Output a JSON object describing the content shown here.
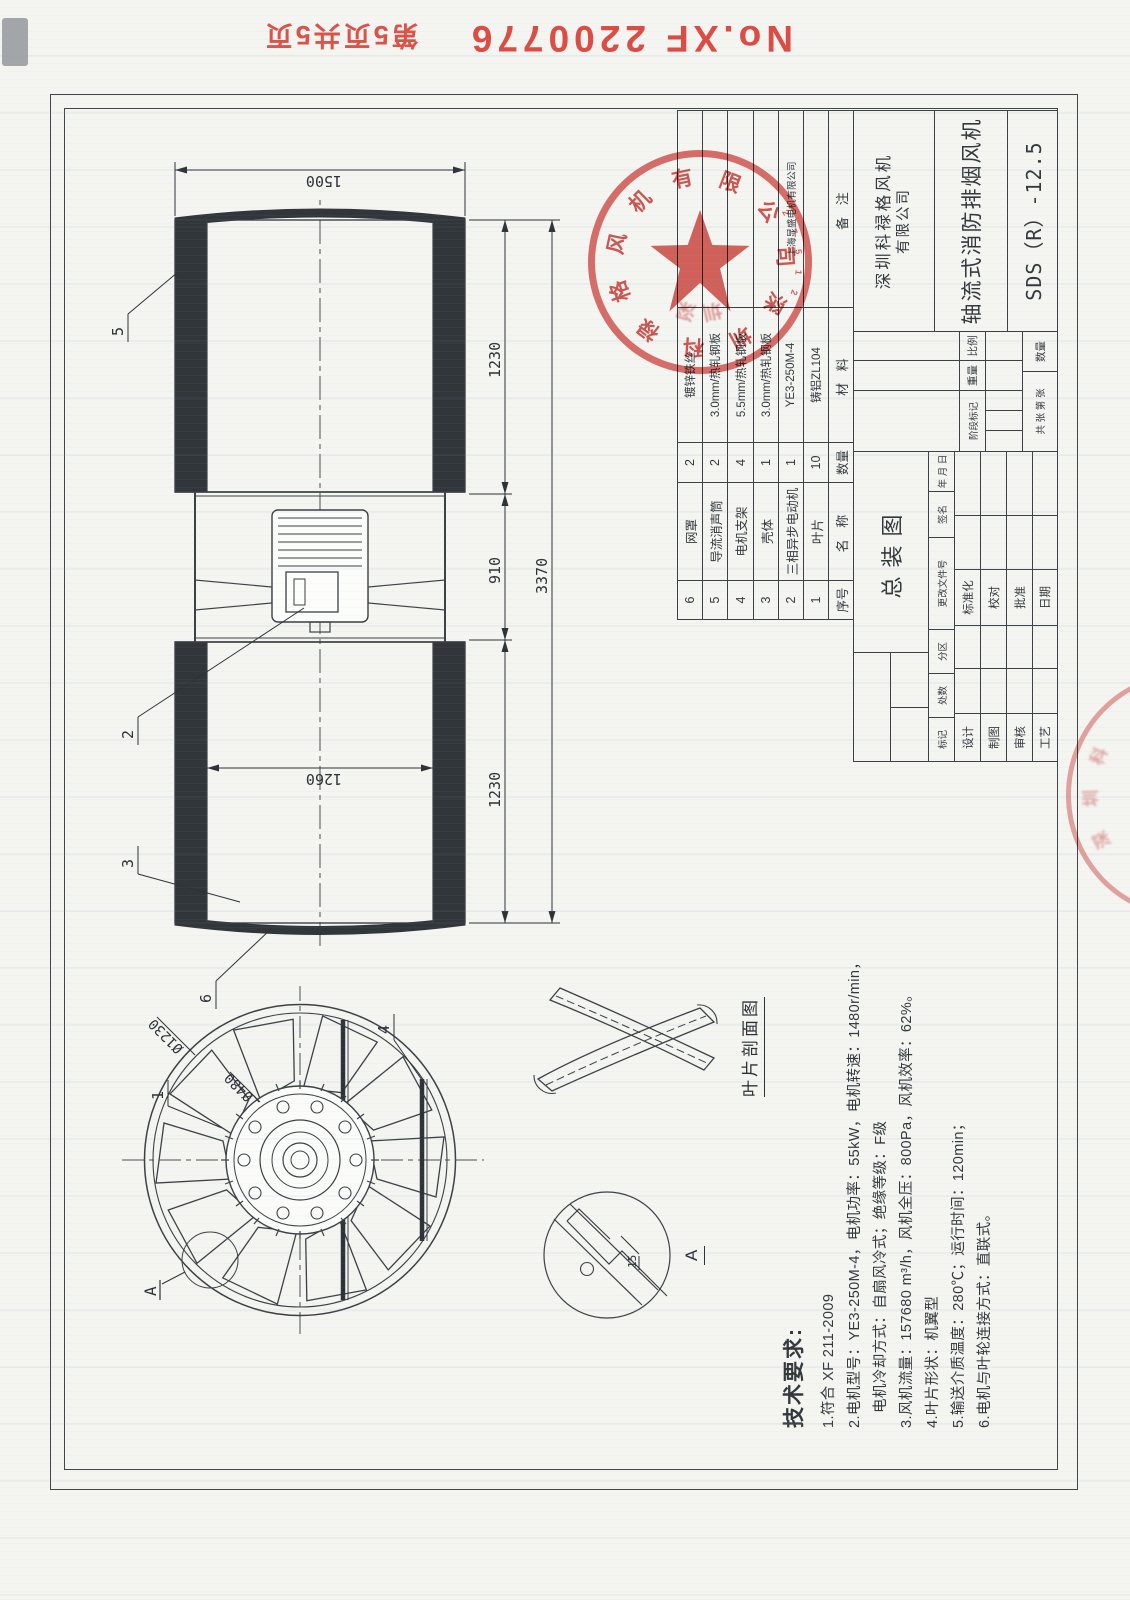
{
  "document": {
    "doc_no": "No.XF 2200776",
    "page_info": "第5页共5页"
  },
  "side_view": {
    "dim_diameter": "1500",
    "dim_inner_diameter": "1260",
    "dim_left": "1230",
    "dim_mid": "910",
    "dim_right": "1230",
    "dim_total": "3370",
    "callout_mesh": "6",
    "callout_casing": "3",
    "callout_motor": "2",
    "callout_silencer": "5"
  },
  "front_view": {
    "dim_outer": "Ø1230",
    "dim_hub": "Ø480",
    "callout_blade": "1",
    "callout_bracket": "4",
    "detail_mark": "A"
  },
  "detail_view": {
    "label": "A",
    "dim_thickness": "15"
  },
  "section_view": {
    "label": "叶片剖面图"
  },
  "tech_requirements": {
    "title": "技术要求:",
    "lines": [
      "1.符合 XF 211-2009",
      "2.电机型号：YE3-250M-4，电机功率：55kW，电机转速：1480r/min，",
      "电机冷却方式：自扇风冷式；绝缘等级：F级",
      "3.风机流量：157680 m³/h，风机全压：800Pa，风机效率：62%。",
      "4.叶片形状：机翼型",
      "5.输送介质温度：280℃；运行时间：120min；",
      "6.电机与叶轮连接方式：直联式。"
    ]
  },
  "parts_table": {
    "header": {
      "no": "序号",
      "name": "名  称",
      "qty": "数量",
      "material": "材  料",
      "remark": "备  注"
    },
    "rows": [
      {
        "no": "6",
        "name": "网罩",
        "qty": "2",
        "material": "镀锌铁丝",
        "remark": ""
      },
      {
        "no": "5",
        "name": "导流消声筒",
        "qty": "2",
        "material": "3.0mm/热轧钢板",
        "remark": ""
      },
      {
        "no": "4",
        "name": "电机支架",
        "qty": "4",
        "material": "5.5mm/热轧钢板",
        "remark": ""
      },
      {
        "no": "3",
        "name": "壳体",
        "qty": "1",
        "material": "3.0mm/热轧钢板",
        "remark": ""
      },
      {
        "no": "2",
        "name": "三相异步电动机",
        "qty": "1",
        "material": "YE3-250M-4",
        "remark": "上海显盛电机有限公司"
      },
      {
        "no": "1",
        "name": "叶片",
        "qty": "10",
        "material": "铸铝ZL104",
        "remark": ""
      }
    ]
  },
  "title_block": {
    "drawing_name": "总装图",
    "company_line1": "深圳科禄格风机",
    "company_line2": "有限公司",
    "product_name": "轴流式消防排烟风机",
    "model": "SDS（R）-12.5",
    "rev_labels": [
      "标记",
      "处数",
      "分区",
      "更改文件号",
      "签名",
      "年 月 日"
    ],
    "sig_left": [
      "设计",
      "制图",
      "审核",
      "工艺"
    ],
    "sig_right": [
      "标准化",
      "校对",
      "批准",
      "日期"
    ],
    "stage_label": "阶段标记",
    "weight_label": "重量",
    "scale_label": "比例",
    "sheets_label": "共  张 第  张",
    "qty_label": "数量"
  },
  "stamps": {
    "company_seal_text": "深圳科禄格风机有限公司",
    "company_seal_chars": [
      "深",
      "圳",
      "科",
      "禄",
      "格",
      "风",
      "机",
      "有",
      "限",
      "公",
      "司"
    ],
    "seal_code_digits": [
      "2",
      "7",
      "5",
      "1",
      "2"
    ],
    "seal_ghost_chars": [
      "深",
      "圳"
    ],
    "margin_seal_chars": [
      "深",
      "圳",
      "科"
    ]
  }
}
